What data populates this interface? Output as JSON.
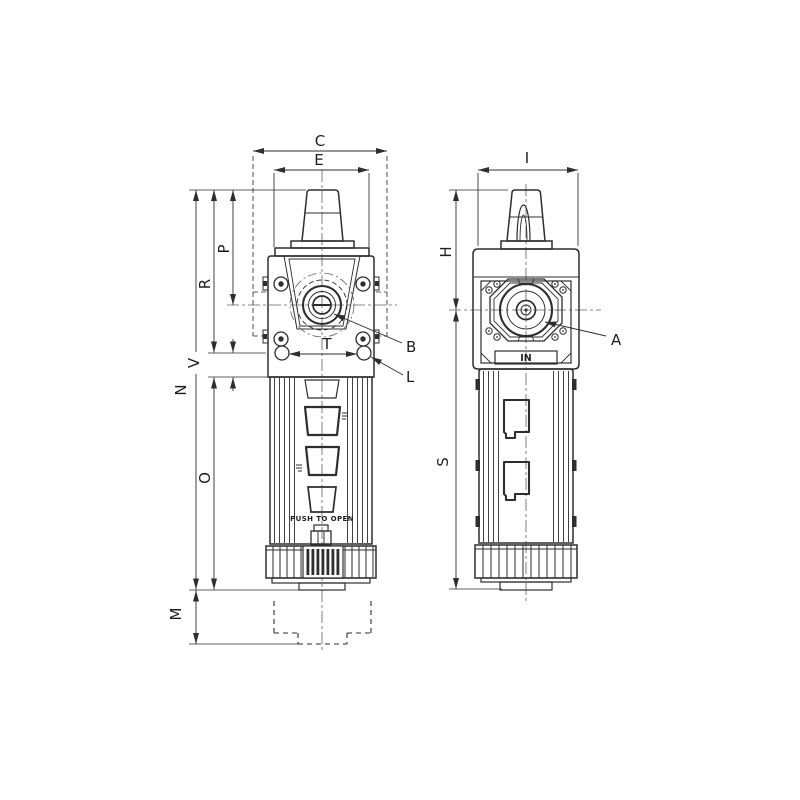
{
  "drawing": {
    "background": "#ffffff",
    "line_color": "#2e2e2e",
    "centerline_color": "#606060",
    "front_view": {
      "dim_c": "C",
      "dim_e": "E",
      "dim_p": "P",
      "dim_r": "R",
      "dim_v": "V",
      "dim_n": "N",
      "dim_o": "O",
      "dim_m": "M",
      "dim_t": "T",
      "callout_b": "B",
      "callout_l": "L",
      "drain_instruction": "PUSH TO OPEN"
    },
    "side_view": {
      "dim_i": "I",
      "dim_h": "H",
      "dim_s": "S",
      "callout_a": "A",
      "inlet_port_label": "IN"
    }
  }
}
